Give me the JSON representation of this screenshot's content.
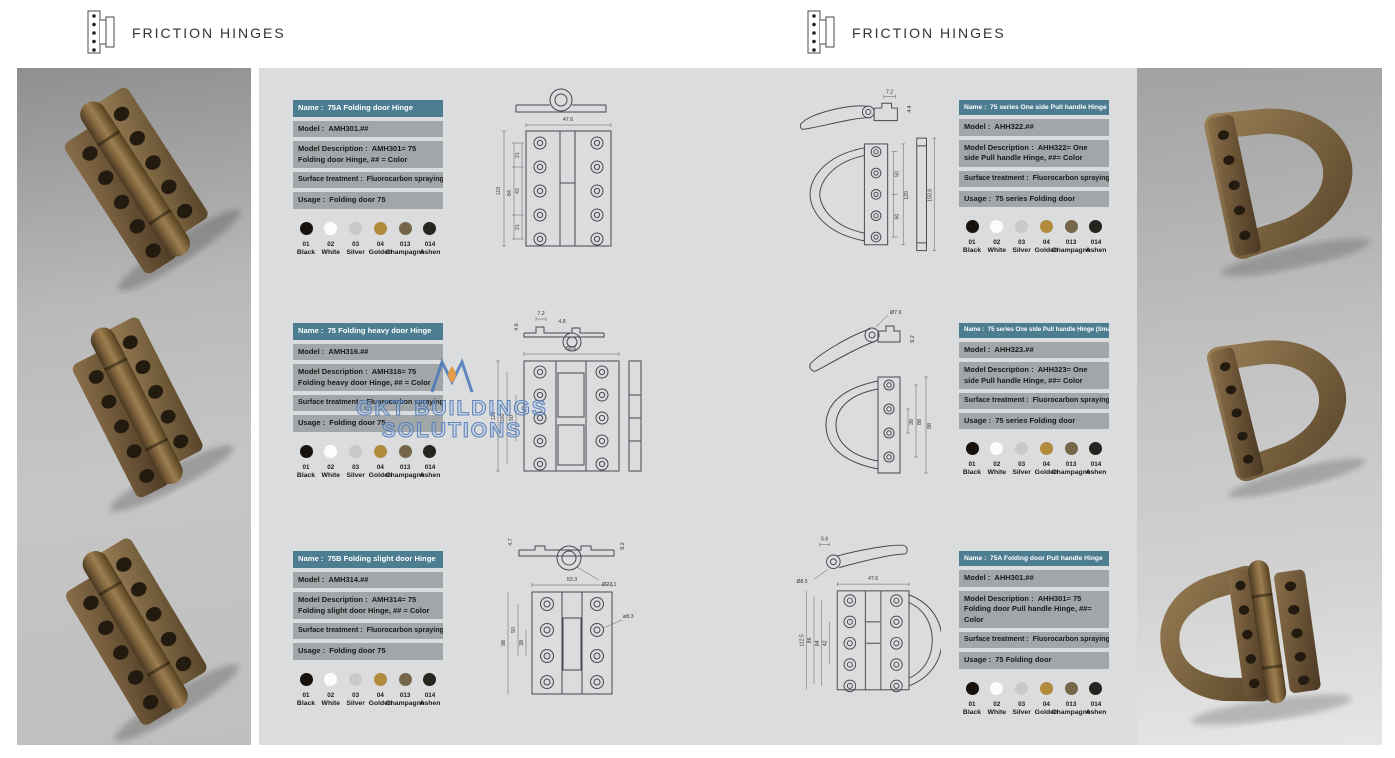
{
  "brand": {
    "title": "FRICTION HINGES"
  },
  "watermark": {
    "line1": "GKT BUILDINGS",
    "line2": "SOLUTIONS"
  },
  "labels": {
    "name": "Name :",
    "model": "Model :",
    "desc": "Model Description :",
    "surface": "Surface treatment :",
    "usage": "Usage :"
  },
  "swatches": [
    {
      "code": "01",
      "name": "Black",
      "hex": "#17120e"
    },
    {
      "code": "02",
      "name": "White",
      "hex": "#fcfcfa"
    },
    {
      "code": "03",
      "name": "Silver",
      "hex": "#c9c9c7"
    },
    {
      "code": "04",
      "name": "Golden",
      "hex": "#b18a3c"
    },
    {
      "code": "013",
      "name": "Champagne",
      "hex": "#756649"
    },
    {
      "code": "014",
      "name": "Ashen",
      "hex": "#26241f"
    }
  ],
  "products_left": [
    {
      "name": "75A Folding door Hinge",
      "model": "AMH301.##",
      "desc": "AMH301= 75 Folding door Hinge, ## = Color",
      "surface": "Fluorocarbon spraying",
      "usage": "Folding door 75",
      "dims": {
        "w": "47.6",
        "h": "110",
        "a": "21",
        "b": "42",
        "c": "21",
        "d": "84"
      }
    },
    {
      "name": "75 Folding heavy door Hinge",
      "model": "AMH316.##",
      "desc": "AMH316= 75 Folding heavy door Hinge, ## = Color",
      "surface": "Fluorocarbon spraying",
      "usage": "Folding door 75",
      "dims": {
        "t1": "7.2",
        "t2": "4.8",
        "t3": "4.6",
        "w": "83.6",
        "h": "120",
        "m": "100",
        "s": "50"
      }
    },
    {
      "name": "75B Folding slight door Hinge",
      "model": "AMH314.##",
      "desc": "AMH314= 75 Folding slight door Hinge, ## = Color",
      "surface": "Fluorocarbon spraying",
      "usage": "Folding door 75",
      "dims": {
        "t1": "4.7",
        "t2": "9.2",
        "knuckle": "Ø27.1",
        "w": "53.3",
        "h": "98",
        "m": "50",
        "s": "38",
        "hole": "ø8.3"
      }
    }
  ],
  "products_right": [
    {
      "name": "75 series One side Pull handle Hinge",
      "model": "AHH322.##",
      "desc": "AHH322= One side Pull handle Hinge, ##= Color",
      "surface": "Fluorocarbon spraying",
      "usage": "75 series Folding door",
      "dims": {
        "t1": "7.2",
        "t2": "4.4",
        "h": "120",
        "side": "150.8",
        "s1": "50",
        "s2": "50"
      }
    },
    {
      "name": "75 series One side Pull handle Hinge (Small)",
      "model": "AHH323.##",
      "desc": "AHH323= One side Pull handle Hinge, ##= Color",
      "surface": "Fluorocarbon spraying",
      "usage": "75 series Folding door",
      "dims": {
        "knuckle": "Ø7.9",
        "t1": "9.2",
        "s": "38",
        "m": "88",
        "h": "98"
      }
    },
    {
      "name": "75A Folding door Pull handle Hinge",
      "model": "AHH301.##",
      "desc": "AHH301= 75 Folding door Pull handle Hinge, ##= Color",
      "surface": "Fluorocarbon spraying",
      "usage": "75 Folding door",
      "dims": {
        "t1": "5.6",
        "knuckle": "Ø8.5",
        "w": "47.6",
        "h": "112.5",
        "m": "86",
        "a": "84",
        "b": "42"
      }
    }
  ]
}
